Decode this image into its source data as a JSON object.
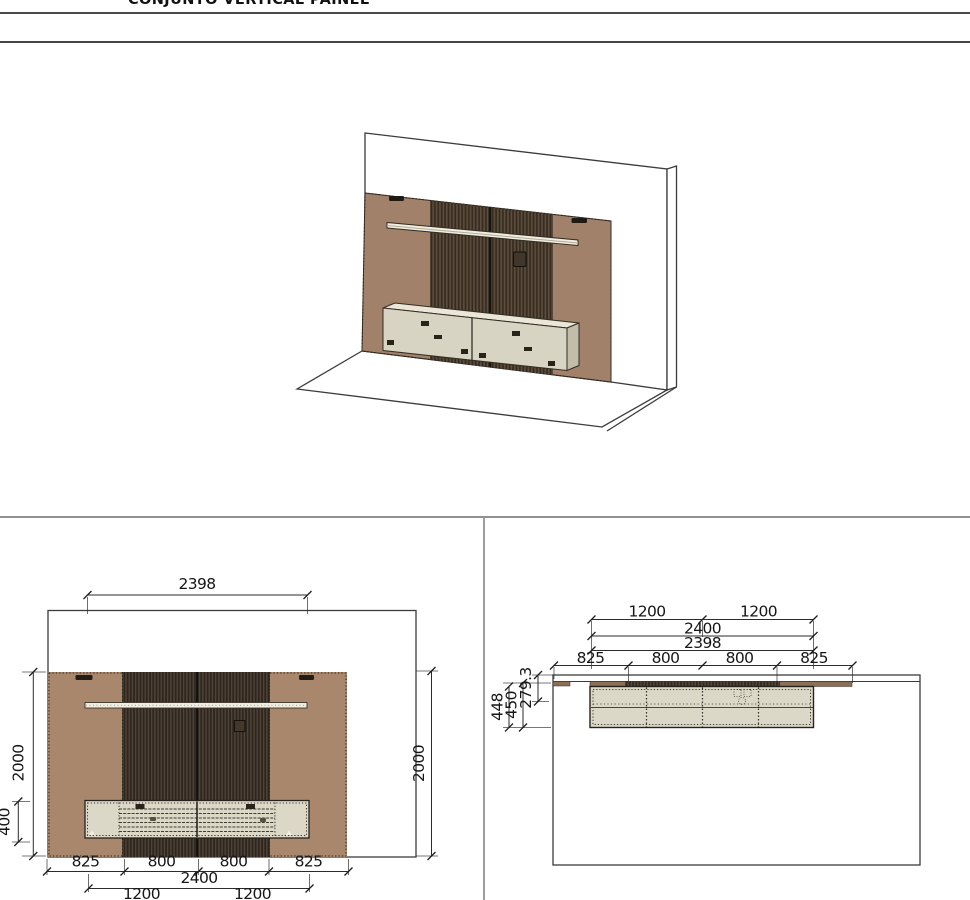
{
  "header": {
    "title": "CONJUNTO VERTICAL PAINEL"
  },
  "colors": {
    "wood_front": "#a8876c",
    "wood_iso": "#a1816a",
    "wood_plan": "#8d6f55",
    "slat_dark": "#2c2620",
    "slat_stripe_iso": "#5f4f3e",
    "cabinet_front": "#dcd8c8",
    "cabinet_iso": "#d8d4c4",
    "cabinet_top_iso": "#eae6d8",
    "cabinet_side_iso": "#c2bdab",
    "shelf": "#f0ede2",
    "dimension_line": "#2b2b2b"
  },
  "front_view": {
    "dim_shelf_width": "2398",
    "dim_panel_height_left": "2000",
    "dim_cabinet_height": "400",
    "dim_panel_height_right": "2000",
    "dim_segments": [
      "825",
      "800",
      "800",
      "825"
    ],
    "dim_cabinet_width": "2400",
    "dim_halves": [
      "1200",
      "1200"
    ]
  },
  "plan_view": {
    "dim_halves": [
      "1200",
      "1200"
    ],
    "dim_cabinet_width": "2400",
    "dim_shelf_width": "2398",
    "dim_segments": [
      "825",
      "800",
      "800",
      "825"
    ],
    "dim_cabinet_depth": "448",
    "dim_depth_total": "450",
    "dim_shelf_depth": "279.3"
  }
}
